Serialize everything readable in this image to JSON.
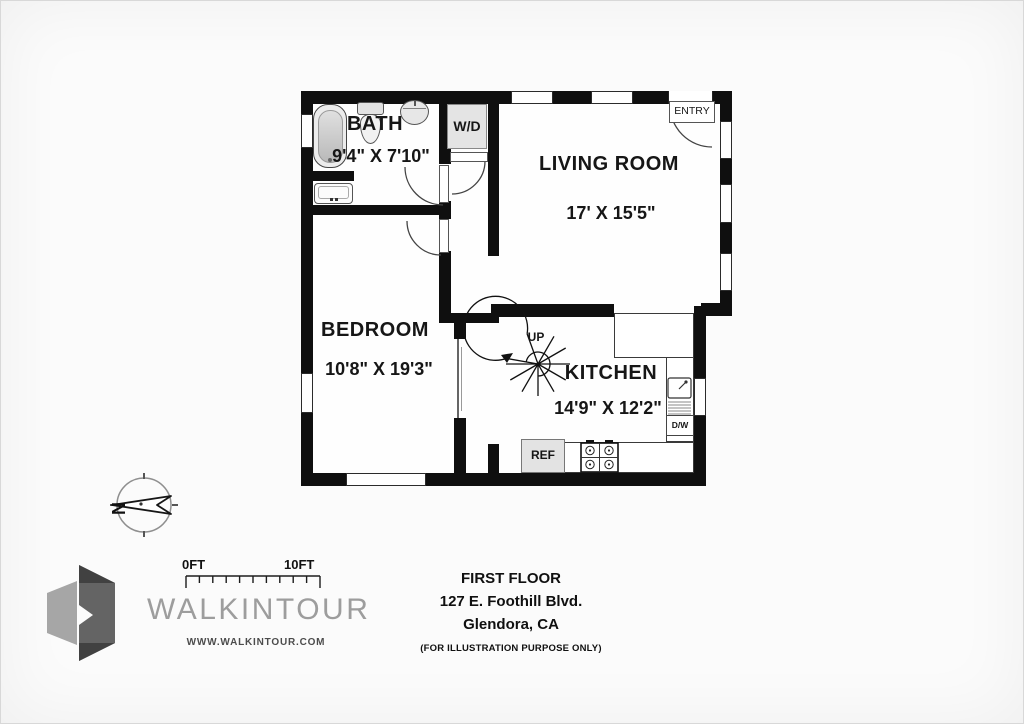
{
  "plan": {
    "rooms": [
      {
        "id": "bath",
        "name": "BATH",
        "dims": "9'4\" X 7'10\""
      },
      {
        "id": "living",
        "name": "LIVING ROOM",
        "dims": "17' X 15'5\""
      },
      {
        "id": "bedroom",
        "name": "BEDROOM",
        "dims": "10'8\" X 19'3\""
      },
      {
        "id": "kitchen",
        "name": "KITCHEN",
        "dims": "14'9\" X 12'2\""
      }
    ],
    "labels": {
      "wd": "W/D",
      "entry": "ENTRY",
      "up": "UP",
      "ref": "REF",
      "dw": "D/W"
    },
    "compass_north": "N",
    "fixtures": [
      "bathtub",
      "toilet",
      "pedestal-sink",
      "vanity-sink",
      "washer-dryer",
      "spiral-staircase",
      "kitchen-sink",
      "dishwasher",
      "refrigerator",
      "stove",
      "sliding-door"
    ]
  },
  "scale_bar": {
    "start": "0FT",
    "end": "10FT"
  },
  "brand": {
    "name": "WALKINTOUR",
    "website": "WWW.WALKINTOUR.COM"
  },
  "title_block": {
    "floor": "FIRST FLOOR",
    "address": "127 E. Foothill Blvd.",
    "city": "Glendora, CA",
    "disclaimer": "(FOR ILLUSTRATION PURPOSE ONLY)"
  },
  "colors": {
    "wall": "#0f0f0f",
    "appliance_fill": "#e3e3e3",
    "brand_gray": "#9d9d9d",
    "text": "#141414",
    "background": "#fbfbfb"
  }
}
